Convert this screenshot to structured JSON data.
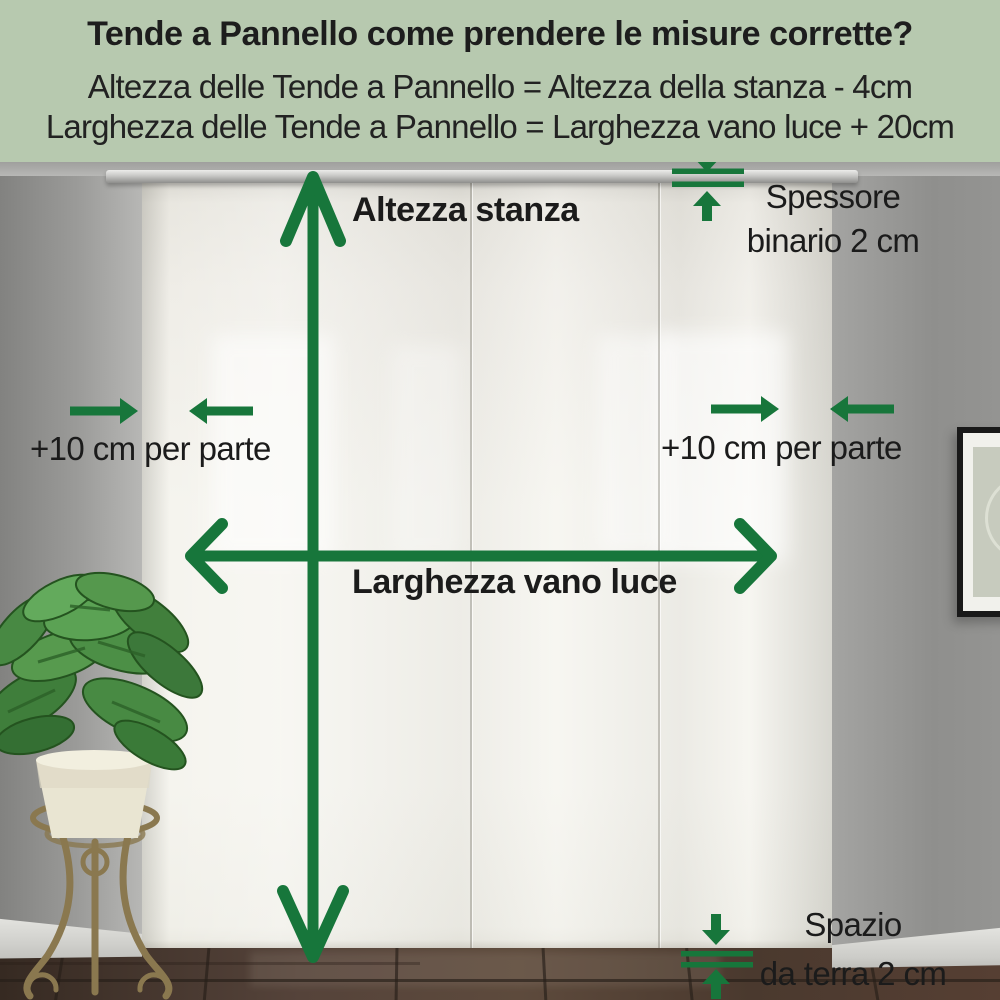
{
  "header": {
    "title": "Tende a Pannello come prendere le misure corrette?",
    "formula_height": "Altezza delle Tende a Pannello = Altezza della stanza - 4cm",
    "formula_width": "Larghezza delle Tende a Pannello = Larghezza vano luce + 20cm",
    "background_color": "#b7c9af"
  },
  "labels": {
    "room_height": "Altezza stanza",
    "window_width": "Larghezza vano luce",
    "side_add_left": "+10 cm per parte",
    "side_add_right": "+10 cm per parte",
    "rail_thickness_line1": "Spessore",
    "rail_thickness_line2": "binario 2 cm",
    "floor_gap_line1": "Spazio",
    "floor_gap_line2": "da terra 2 cm"
  },
  "icons": {
    "vertical_measure": "double-headed-arrow-vertical",
    "horizontal_measure": "double-headed-arrow-horizontal",
    "side_extension_left": "inward-arrows-pair",
    "side_extension_right": "inward-arrows-pair",
    "rail_thickness_gauge": "thickness-gauge-arrows",
    "floor_gap_gauge": "thickness-gauge-arrows"
  },
  "colors": {
    "accent_green": "#17763b",
    "text": "#1b1b1b",
    "curtain": "#f4f3ee",
    "wall_gray": "#929290",
    "floor_brown": "#4e3c31"
  },
  "scene": {
    "description_items": [
      "panel-curtains",
      "curtain-rail",
      "potted-plant-on-stand",
      "picture-frame",
      "tiled-floor"
    ]
  }
}
